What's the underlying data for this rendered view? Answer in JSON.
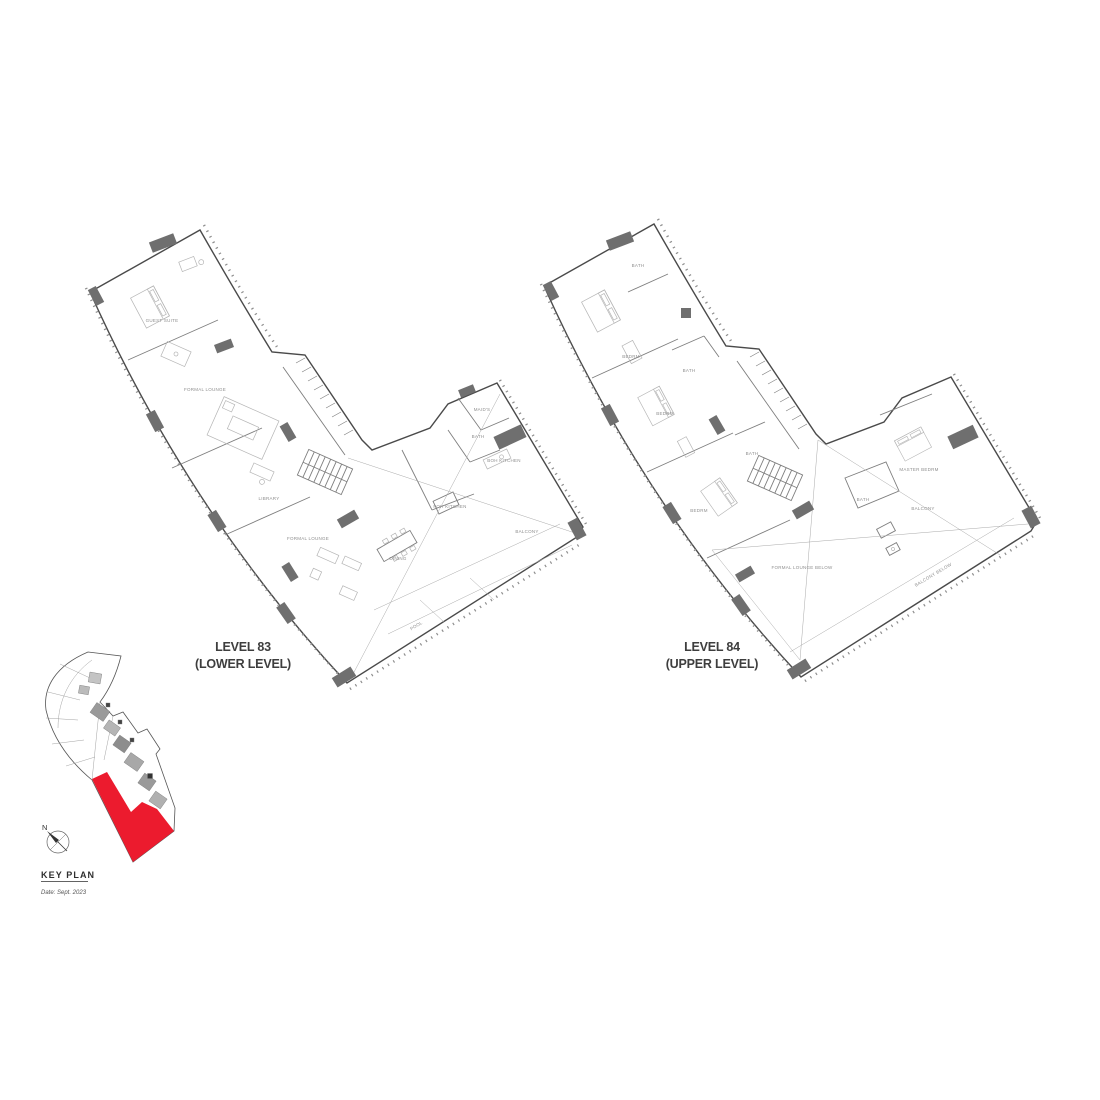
{
  "plans": [
    {
      "name": "LEVEL 83",
      "sublabel": "(LOWER LEVEL)",
      "rooms": [
        "GUEST SUITE",
        "FORMAL LOUNGE",
        "LIBRARY",
        "FORMAL LOUNGE",
        "DINING",
        "FOH KITCHEN",
        "BOH KITCHEN",
        "MAID'S",
        "BATH",
        "BALCONY",
        "POOL"
      ]
    },
    {
      "name": "LEVEL 84",
      "sublabel": "(UPPER LEVEL)",
      "rooms": [
        "BATH",
        "BEDRM",
        "BATH",
        "BEDRM",
        "BATH",
        "BEDRM",
        "BATH",
        "MASTER BEDRM",
        "BALCONY",
        "FORMAL LOUNGE BELOW",
        "BALCONY BELOW"
      ]
    }
  ],
  "key_plan": {
    "title": "KEY PLAN",
    "date_note": "Date: Sept. 2023",
    "north_label": "N",
    "highlight_color": "#EC1B2E"
  }
}
